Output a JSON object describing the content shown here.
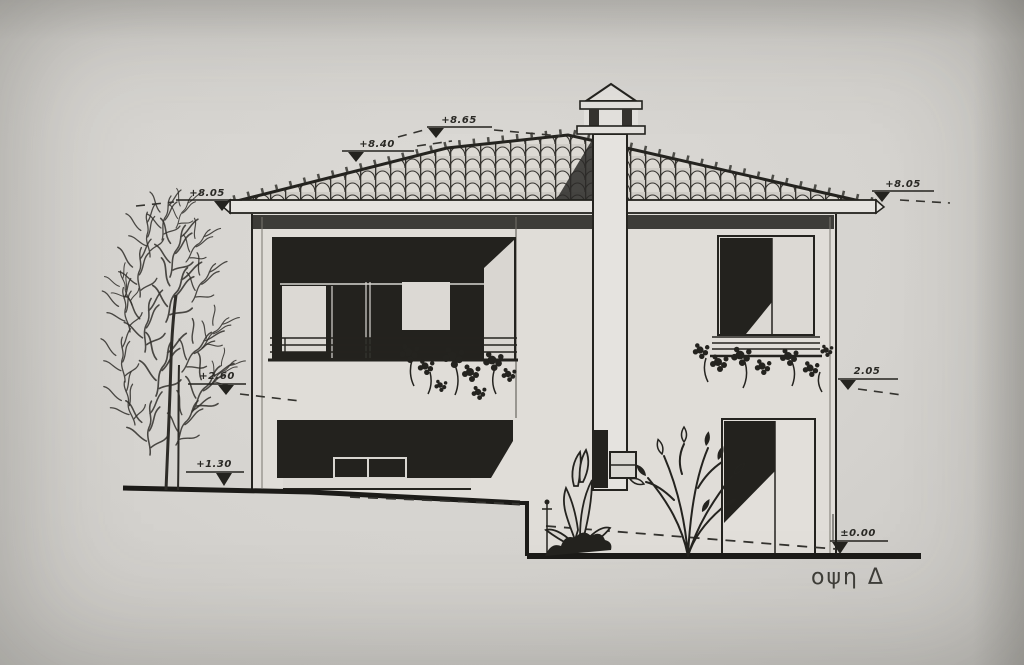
{
  "drawing": {
    "title": "οψη  Δ",
    "type_note": "architectural elevation (Greek: view D)",
    "colors": {
      "paper": "#d6d4d0",
      "ink": "#24231f",
      "shadow_fill": "#23221e",
      "wall": "#e0ddd8",
      "tile": "#cfccc6"
    },
    "markers": {
      "eave_left": {
        "value": "+8.05"
      },
      "roof_mid": {
        "value": "+8.40"
      },
      "ridge": {
        "value": "+8.65"
      },
      "eave_right": {
        "value": "+8.05"
      },
      "floor_left": {
        "value": "+2.60"
      },
      "floor_right": {
        "value": "2.05"
      },
      "ground_left": {
        "value": "+1.30"
      },
      "ground_right": {
        "value": "±0.00"
      }
    }
  }
}
